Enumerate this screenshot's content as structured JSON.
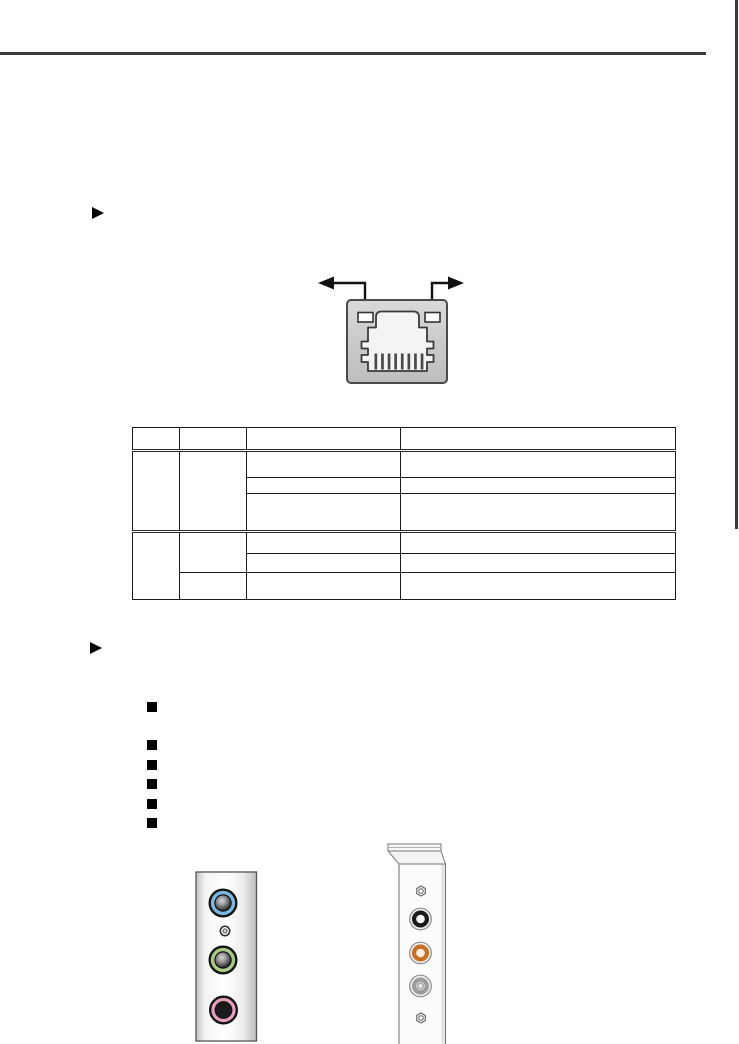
{
  "page": {
    "background": "#ffffff",
    "top_rule_color": "#3a3a3a",
    "side_tab_color": "#3a3a3a"
  },
  "sections": [
    {
      "bullet_icon": "triangle-right",
      "heading": ""
    },
    {
      "bullet_icon": "triangle-right",
      "heading": ""
    }
  ],
  "lan_diagram": {
    "type": "rj45-port-with-led-callouts",
    "port_fill_top": "#d9d9d9",
    "port_fill_bottom": "#bdbdbd",
    "port_border": "#4a4a4a",
    "led_fill": "#ffffff",
    "led_border": "#333333",
    "cavity_fill": "#f4f4f4",
    "cavity_border": "#3a3a3a",
    "pin_color": "#4a4a4a",
    "pin_count": 8,
    "arrow_color": "#111111",
    "led_count": 2
  },
  "table": {
    "header": [
      "",
      "",
      "",
      ""
    ],
    "sections": [
      {
        "rows": [
          [
            "",
            "",
            "",
            ""
          ],
          [
            "",
            ""
          ],
          [
            "",
            ""
          ]
        ]
      },
      {
        "rows": [
          [
            "",
            "",
            "",
            ""
          ],
          [
            "",
            ""
          ],
          [
            "",
            "",
            ""
          ]
        ]
      }
    ]
  },
  "bullet_list": {
    "items": [
      "",
      "",
      "",
      "",
      "",
      ""
    ]
  },
  "audio_panel_left": {
    "panel_border": "#555555",
    "jacks": [
      {
        "name": "blue-jack",
        "ring_color": "#79b8e0",
        "center": "gradient-knob"
      },
      {
        "name": "screw-hole",
        "ring_color": "#2a2a2a",
        "center": "small-ring"
      },
      {
        "name": "green-jack",
        "ring_color": "#a8cc86",
        "center": "gradient-knob"
      },
      {
        "name": "pink-jack",
        "ring_color": "#e79fc0",
        "center": "solid-dark"
      }
    ]
  },
  "audio_bracket_right": {
    "bracket_border": "#777777",
    "items": [
      {
        "name": "hex-screw-top"
      },
      {
        "name": "black-jack",
        "ring_color": "#1a1a1a"
      },
      {
        "name": "orange-jack",
        "ring_color": "#c8701f"
      },
      {
        "name": "gray-jack",
        "ring_color": "#9c9c9c"
      },
      {
        "name": "hex-screw-bottom"
      }
    ]
  }
}
